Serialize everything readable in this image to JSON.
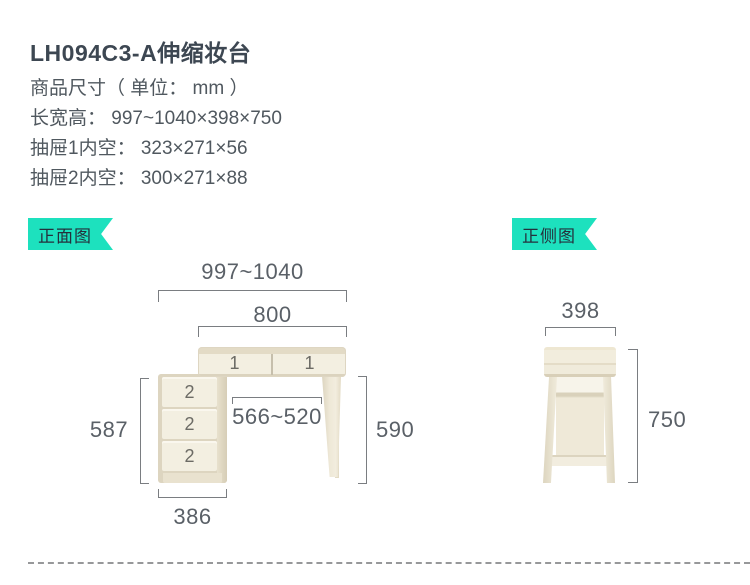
{
  "header": {
    "title": "LH094C3-A伸缩妆台",
    "spec_lines": [
      "商品尺寸（ 单位： mm ）",
      "长宽高： 997~1040×398×750",
      "抽屉1内空： 323×271×56",
      "抽屉2内空： 300×271×88"
    ]
  },
  "front_view": {
    "tag": "正面图",
    "dims": {
      "total_width": "997~1040",
      "desk_width": "800",
      "knee_clearance": "566~520",
      "cabinet_height": "587",
      "under_desk_height": "590",
      "cabinet_width": "386"
    },
    "desk_drawer_labels": [
      "1",
      "1"
    ],
    "cabinet_drawer_labels": [
      "2",
      "2",
      "2"
    ]
  },
  "side_view": {
    "tag": "正侧图",
    "dims": {
      "depth": "398",
      "height": "750"
    }
  },
  "colors": {
    "accent": "#1DE1BE",
    "title_ink": "#3D4752",
    "dimension_ink": "#5A6067",
    "furniture_cream": "#F2EDDE"
  }
}
